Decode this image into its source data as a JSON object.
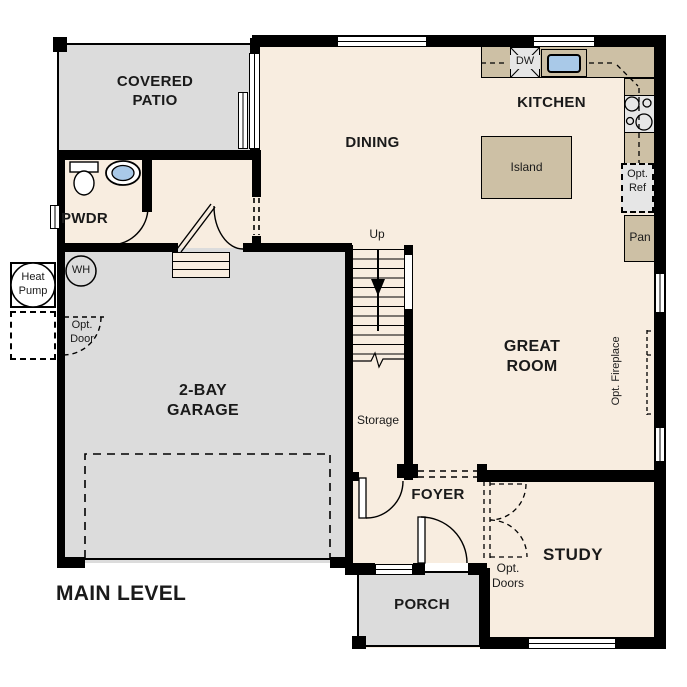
{
  "plan": {
    "title": "MAIN LEVEL",
    "rooms": {
      "covered_patio": {
        "line1": "COVERED",
        "line2": "PATIO"
      },
      "pwdr": "PWDR",
      "dining": "DINING",
      "kitchen": "KITCHEN",
      "great_room": {
        "line1": "GREAT",
        "line2": "ROOM"
      },
      "garage": {
        "line1": "2-BAY",
        "line2": "GARAGE"
      },
      "foyer": "FOYER",
      "study": "STUDY",
      "porch": "PORCH",
      "storage": "Storage"
    },
    "fixtures": {
      "island": "Island",
      "dw": "DW",
      "pan": "Pan",
      "opt_ref": {
        "line1": "Opt.",
        "line2": "Ref"
      },
      "opt_door": {
        "line1": "Opt.",
        "line2": "Door"
      },
      "opt_doors": {
        "line1": "Opt.",
        "line2": "Doors"
      },
      "opt_fireplace": "Opt. Fireplace",
      "heat_pump": {
        "line1": "Heat",
        "line2": "Pump"
      },
      "wh": "WH",
      "up": "Up"
    },
    "colors": {
      "floor": "#f8ede0",
      "hardscape": "#dcdcdc",
      "counter": "#cdc0a5",
      "sink_blue": "#a9c9e8",
      "appliance": "#e6e6e6",
      "wall": "#000000"
    }
  }
}
